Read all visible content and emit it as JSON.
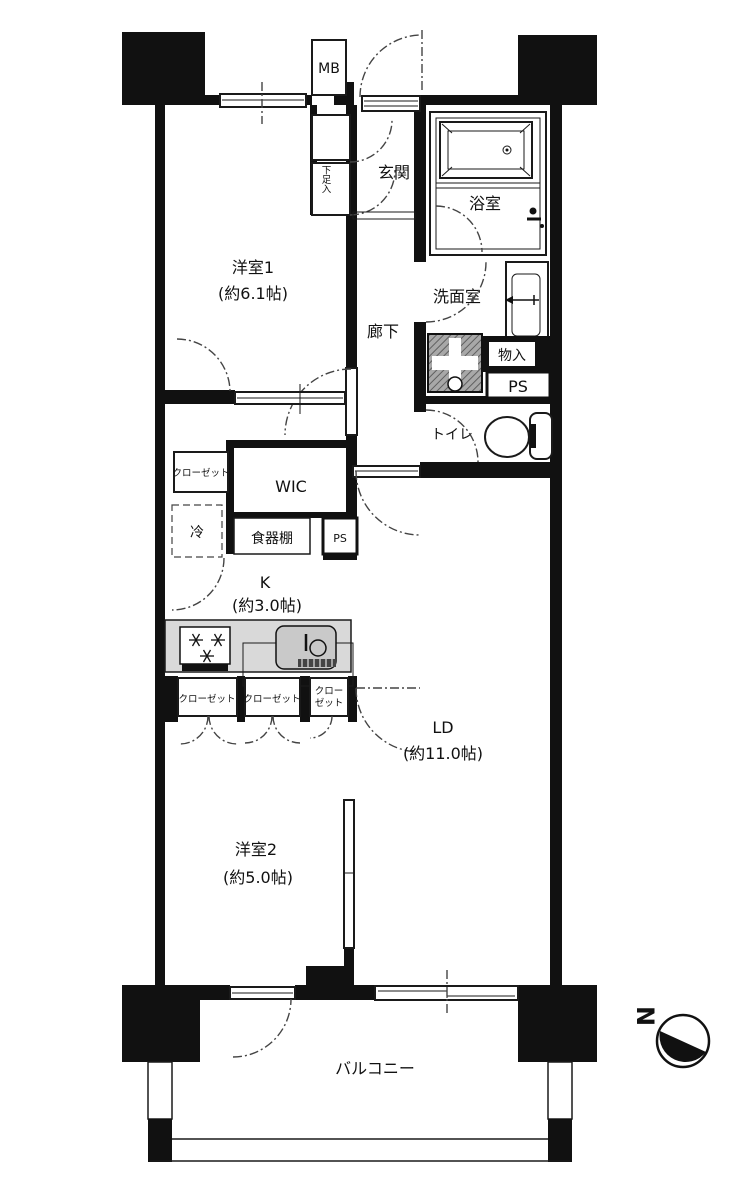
{
  "plan": {
    "type": "japanese-apartment-floorplan",
    "colors": {
      "wall": "#111111",
      "counter_fill": "#d9d9d9",
      "sink_fill": "#c9c9c9",
      "washer_pan_fill": "#9a9a9a",
      "line": "#1a1a1a"
    },
    "labels": {
      "mb": "MB",
      "genkan": "玄関",
      "getabako": "下足入",
      "bath": "浴室",
      "room1_name": "洋室1",
      "room1_size": "(約6.1帖)",
      "corridor": "廊下",
      "washroom": "洗面室",
      "monoire": "物入",
      "ps_upper": "PS",
      "toilet": "トイレ",
      "closet_room1": "クローゼット",
      "wic": "WIC",
      "fridge": "冷",
      "cupboard": "食器棚",
      "ps_lower": "PS",
      "kitchen_name": "K",
      "kitchen_size": "(約3.0帖)",
      "closet_k1": "クローゼット",
      "closet_k2": "クローゼット",
      "closet_k3_line1": "クロー",
      "closet_k3_line2": "ゼット",
      "ld_name": "LD",
      "ld_size": "(約11.0帖)",
      "room2_name": "洋室2",
      "room2_size": "(約5.0帖)",
      "balcony": "バルコニー",
      "north": "N"
    }
  }
}
